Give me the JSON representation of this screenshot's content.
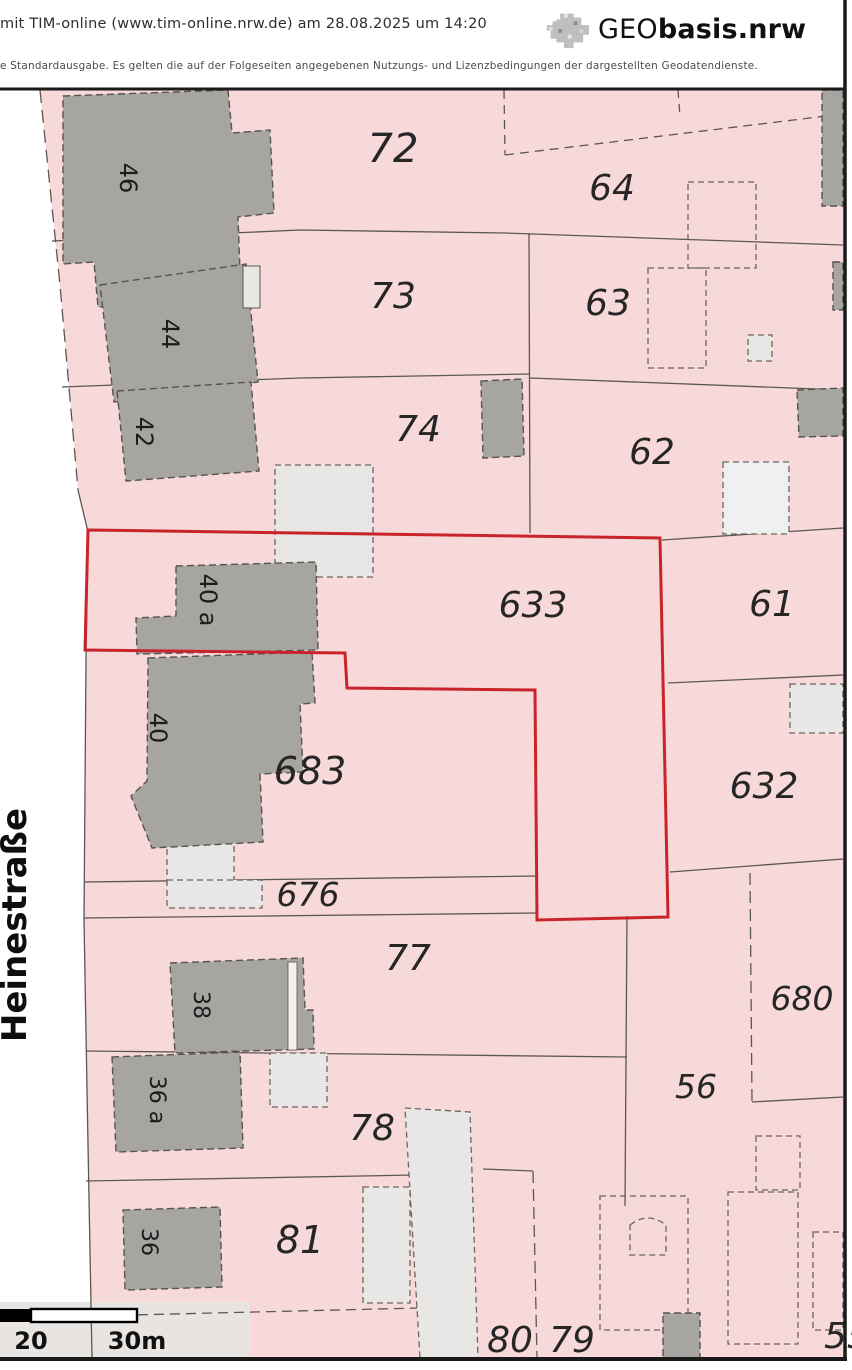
{
  "header": {
    "generated_line": "mit TIM-online (www.tim-online.nrw.de) am 28.08.2025 um 14:20",
    "disclaimer": "e Standardausgabe. Es gelten die auf der Folgeseiten angegebenen Nutzungs- und Lizenzbedingungen der dargestellten Geodatendienste.",
    "logo": {
      "geo": "GEO",
      "basis": "basis.nrw"
    }
  },
  "map": {
    "street_label": "Heinestraße",
    "parcels": [
      "72",
      "64",
      "73",
      "63",
      "74",
      "62",
      "633",
      "61",
      "683",
      "632",
      "676",
      "77",
      "680",
      "56",
      "78",
      "81",
      "80",
      "79",
      "55"
    ],
    "houses": [
      "46",
      "44",
      "42",
      "40 a",
      "40",
      "38",
      "36 a",
      "36"
    ],
    "scale_bar": {
      "label_mid": "20",
      "label_end": "30m"
    },
    "colors": {
      "parcel_fill": "#f8d9d9",
      "building_fill": "#a7a5a2",
      "building_light_fill": "#e9e7e5",
      "boundary_line": "#5c5751",
      "highlight_outline": "#c9242b",
      "map_border": "#1a1a1a"
    }
  }
}
